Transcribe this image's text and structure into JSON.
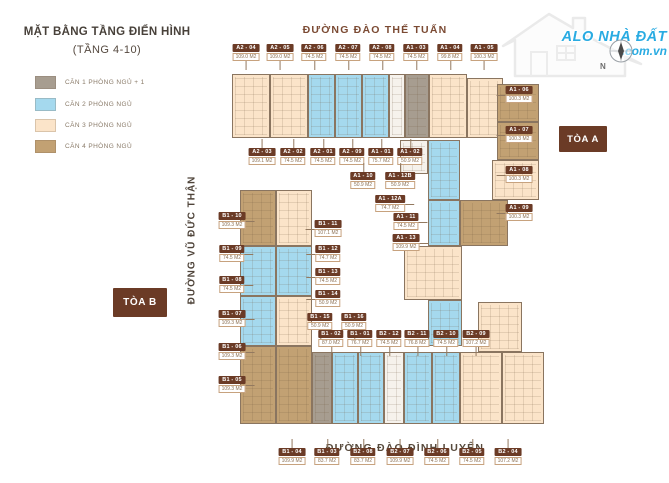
{
  "meta": {
    "title": "MẶT BẰNG TẦNG ĐIỂN HÌNH",
    "subtitle": "(TẦNG 4-10)"
  },
  "legend": [
    {
      "label": "CĂN 1 PHÒNG NGỦ + 1",
      "color": "#a79d90"
    },
    {
      "label": "CĂN 2 PHÒNG NGỦ",
      "color": "#a5d9ee"
    },
    {
      "label": "CĂN 3 PHÒNG NGỦ",
      "color": "#fbe4c9"
    },
    {
      "label": "CĂN 4 PHÒNG NGỦ",
      "color": "#c2a173"
    }
  ],
  "streets": {
    "top": "ĐƯỜNG ĐÀO THẾ TUẤN",
    "left": "ĐƯỜNG VŨ ĐỨC THẬN",
    "bottom": "ĐƯỜNG ĐÀO ĐÌNH LUYỆN"
  },
  "towers": {
    "a": "TÒA A",
    "b": "TÒA B"
  },
  "logo": {
    "line1": "ALO NHÀ ĐẤT",
    "line2": ".com.vn",
    "color": "#29abe2"
  },
  "compass": {
    "label": "N"
  },
  "colors": {
    "1": "#a79d90",
    "2": "#a5d9ee",
    "3": "#fbe4c9",
    "4": "#c2a173",
    "core": "#f6f2ec",
    "label_box": "#6b3b26",
    "street_top": "#7b4a33",
    "street_dark": "#574a3c"
  },
  "plan": {
    "blocks": [
      {
        "x": 232,
        "y": 74,
        "w": 38,
        "h": 64,
        "t": "3"
      },
      {
        "x": 270,
        "y": 74,
        "w": 38,
        "h": 64,
        "t": "3"
      },
      {
        "x": 308,
        "y": 74,
        "w": 27,
        "h": 64,
        "t": "2"
      },
      {
        "x": 335,
        "y": 74,
        "w": 27,
        "h": 64,
        "t": "2"
      },
      {
        "x": 362,
        "y": 74,
        "w": 27,
        "h": 64,
        "t": "2"
      },
      {
        "x": 389,
        "y": 74,
        "w": 16,
        "h": 64,
        "t": "core"
      },
      {
        "x": 405,
        "y": 74,
        "w": 24,
        "h": 64,
        "t": "1"
      },
      {
        "x": 429,
        "y": 74,
        "w": 38,
        "h": 64,
        "t": "3"
      },
      {
        "x": 467,
        "y": 78,
        "w": 36,
        "h": 60,
        "t": "3"
      },
      {
        "x": 497,
        "y": 84,
        "w": 42,
        "h": 38,
        "t": "4"
      },
      {
        "x": 497,
        "y": 122,
        "w": 42,
        "h": 38,
        "t": "4"
      },
      {
        "x": 492,
        "y": 160,
        "w": 47,
        "h": 40,
        "t": "3"
      },
      {
        "x": 460,
        "y": 200,
        "w": 48,
        "h": 46,
        "t": "4"
      },
      {
        "x": 428,
        "y": 140,
        "w": 32,
        "h": 60,
        "t": "2"
      },
      {
        "x": 400,
        "y": 140,
        "w": 28,
        "h": 34,
        "t": "core"
      },
      {
        "x": 428,
        "y": 200,
        "w": 32,
        "h": 46,
        "t": "2"
      },
      {
        "x": 404,
        "y": 246,
        "w": 58,
        "h": 54,
        "t": "3"
      },
      {
        "x": 428,
        "y": 300,
        "w": 34,
        "h": 46,
        "t": "2"
      },
      {
        "x": 478,
        "y": 302,
        "w": 44,
        "h": 50,
        "t": "3"
      },
      {
        "x": 240,
        "y": 190,
        "w": 36,
        "h": 56,
        "t": "4"
      },
      {
        "x": 276,
        "y": 190,
        "w": 36,
        "h": 56,
        "t": "3"
      },
      {
        "x": 240,
        "y": 246,
        "w": 36,
        "h": 50,
        "t": "2"
      },
      {
        "x": 276,
        "y": 246,
        "w": 36,
        "h": 50,
        "t": "2"
      },
      {
        "x": 240,
        "y": 296,
        "w": 36,
        "h": 50,
        "t": "2"
      },
      {
        "x": 276,
        "y": 296,
        "w": 36,
        "h": 50,
        "t": "3"
      },
      {
        "x": 240,
        "y": 346,
        "w": 36,
        "h": 78,
        "t": "4"
      },
      {
        "x": 276,
        "y": 346,
        "w": 36,
        "h": 78,
        "t": "4"
      },
      {
        "x": 312,
        "y": 352,
        "w": 20,
        "h": 72,
        "t": "1"
      },
      {
        "x": 332,
        "y": 352,
        "w": 26,
        "h": 72,
        "t": "2"
      },
      {
        "x": 358,
        "y": 352,
        "w": 26,
        "h": 72,
        "t": "2"
      },
      {
        "x": 384,
        "y": 352,
        "w": 20,
        "h": 72,
        "t": "core"
      },
      {
        "x": 404,
        "y": 352,
        "w": 28,
        "h": 72,
        "t": "2"
      },
      {
        "x": 432,
        "y": 352,
        "w": 28,
        "h": 72,
        "t": "2"
      },
      {
        "x": 460,
        "y": 352,
        "w": 42,
        "h": 72,
        "t": "3"
      },
      {
        "x": 502,
        "y": 352,
        "w": 42,
        "h": 72,
        "t": "3"
      }
    ],
    "labels": [
      {
        "code": "A2 - 04",
        "area": "109.0 M2",
        "x": 246,
        "y": 44,
        "dir": "down"
      },
      {
        "code": "A2 - 05",
        "area": "109.0 M2",
        "x": 280,
        "y": 44,
        "dir": "down"
      },
      {
        "code": "A2 - 06",
        "area": "74.5 M2",
        "x": 314,
        "y": 44,
        "dir": "down"
      },
      {
        "code": "A2 - 07",
        "area": "74.5 M2",
        "x": 348,
        "y": 44,
        "dir": "down"
      },
      {
        "code": "A2 - 08",
        "area": "74.5 M2",
        "x": 382,
        "y": 44,
        "dir": "down"
      },
      {
        "code": "A1 - 03",
        "area": "74.5 M2",
        "x": 416,
        "y": 44,
        "dir": "down"
      },
      {
        "code": "A1 - 04",
        "area": "99.8 M2",
        "x": 450,
        "y": 44,
        "dir": "down"
      },
      {
        "code": "A1 - 05",
        "area": "100.3 M2",
        "x": 484,
        "y": 44,
        "dir": "down"
      },
      {
        "code": "A1 - 06",
        "area": "100.3 M2",
        "x": 519,
        "y": 86,
        "dir": "left"
      },
      {
        "code": "A1 - 07",
        "area": "100.3 M2",
        "x": 519,
        "y": 126,
        "dir": "left"
      },
      {
        "code": "A1 - 08",
        "area": "100.3 M2",
        "x": 519,
        "y": 166,
        "dir": "left"
      },
      {
        "code": "A1 - 09",
        "area": "100.3 M2",
        "x": 519,
        "y": 204,
        "dir": "left"
      },
      {
        "code": "A2 - 03",
        "area": "109.1 M2",
        "x": 262,
        "y": 148,
        "dir": "up"
      },
      {
        "code": "A2 - 02",
        "area": "74.5 M2",
        "x": 293,
        "y": 148,
        "dir": "up"
      },
      {
        "code": "A2 - 01",
        "area": "74.5 M2",
        "x": 323,
        "y": 148,
        "dir": "up"
      },
      {
        "code": "A2 - 09",
        "area": "74.5 M2",
        "x": 352,
        "y": 148,
        "dir": "up"
      },
      {
        "code": "A1 - 01",
        "area": "75.7 M2",
        "x": 381,
        "y": 148,
        "dir": "up"
      },
      {
        "code": "A1 - 02",
        "area": "50.9 M2",
        "x": 410,
        "y": 148,
        "dir": "up"
      },
      {
        "code": "A1 - 10",
        "area": "50.9 M2",
        "x": 363,
        "y": 172,
        "dir": "up"
      },
      {
        "code": "A1 - 12B",
        "area": "50.9 M2",
        "x": 400,
        "y": 172,
        "dir": "up"
      },
      {
        "code": "A1 - 12A",
        "area": "74.7 M2",
        "x": 390,
        "y": 195,
        "dir": "right"
      },
      {
        "code": "A1 - 11",
        "area": "74.5 M2",
        "x": 406,
        "y": 213,
        "dir": "right"
      },
      {
        "code": "A1 - 13",
        "area": "109.9 M2",
        "x": 406,
        "y": 234,
        "dir": "right"
      },
      {
        "code": "B1 - 10",
        "area": "109.3 M2",
        "x": 232,
        "y": 212,
        "dir": "right"
      },
      {
        "code": "B1 - 09",
        "area": "74.5 M2",
        "x": 232,
        "y": 245,
        "dir": "right"
      },
      {
        "code": "B1 - 08",
        "area": "74.5 M2",
        "x": 232,
        "y": 276,
        "dir": "right"
      },
      {
        "code": "B1 - 07",
        "area": "109.3 M2",
        "x": 232,
        "y": 310,
        "dir": "right"
      },
      {
        "code": "B1 - 06",
        "area": "109.3 M2",
        "x": 232,
        "y": 343,
        "dir": "right"
      },
      {
        "code": "B1 - 05",
        "area": "109.3 M2",
        "x": 232,
        "y": 376,
        "dir": "right"
      },
      {
        "code": "B1 - 11",
        "area": "107.1 M2",
        "x": 328,
        "y": 220,
        "dir": "left"
      },
      {
        "code": "B1 - 12",
        "area": "74.7 M2",
        "x": 328,
        "y": 245,
        "dir": "left"
      },
      {
        "code": "B1 - 13",
        "area": "74.5 M2",
        "x": 328,
        "y": 268,
        "dir": "left"
      },
      {
        "code": "B1 - 14",
        "area": "50.9 M2",
        "x": 328,
        "y": 290,
        "dir": "left"
      },
      {
        "code": "B1 - 15",
        "area": "50.9 M2",
        "x": 320,
        "y": 313,
        "dir": "down"
      },
      {
        "code": "B1 - 16",
        "area": "50.9 M2",
        "x": 354,
        "y": 313,
        "dir": "down"
      },
      {
        "code": "B1 - 02",
        "area": "87.0 M2",
        "x": 331,
        "y": 330,
        "dir": "down"
      },
      {
        "code": "B1 - 01",
        "area": "76.7 M2",
        "x": 360,
        "y": 330,
        "dir": "down"
      },
      {
        "code": "B2 - 12",
        "area": "74.5 M2",
        "x": 389,
        "y": 330,
        "dir": "down"
      },
      {
        "code": "B2 - 11",
        "area": "76.8 M2",
        "x": 417,
        "y": 330,
        "dir": "down"
      },
      {
        "code": "B2 - 10",
        "area": "74.5 M2",
        "x": 446,
        "y": 330,
        "dir": "down"
      },
      {
        "code": "B2 - 09",
        "area": "107.2 M2",
        "x": 476,
        "y": 330,
        "dir": "down"
      },
      {
        "code": "B1 - 04",
        "area": "109.9 M2",
        "x": 292,
        "y": 448,
        "dir": "up"
      },
      {
        "code": "B1 - 03",
        "area": "83.7 M2",
        "x": 327,
        "y": 448,
        "dir": "up"
      },
      {
        "code": "B2 - 08",
        "area": "83.7 M2",
        "x": 363,
        "y": 448,
        "dir": "up"
      },
      {
        "code": "B2 - 07",
        "area": "109.9 M2",
        "x": 400,
        "y": 448,
        "dir": "up"
      },
      {
        "code": "B2 - 06",
        "area": "74.5 M2",
        "x": 437,
        "y": 448,
        "dir": "up"
      },
      {
        "code": "B2 - 05",
        "area": "74.5 M2",
        "x": 472,
        "y": 448,
        "dir": "up"
      },
      {
        "code": "B2 - 04",
        "area": "107.2 M2",
        "x": 508,
        "y": 448,
        "dir": "up"
      }
    ]
  }
}
